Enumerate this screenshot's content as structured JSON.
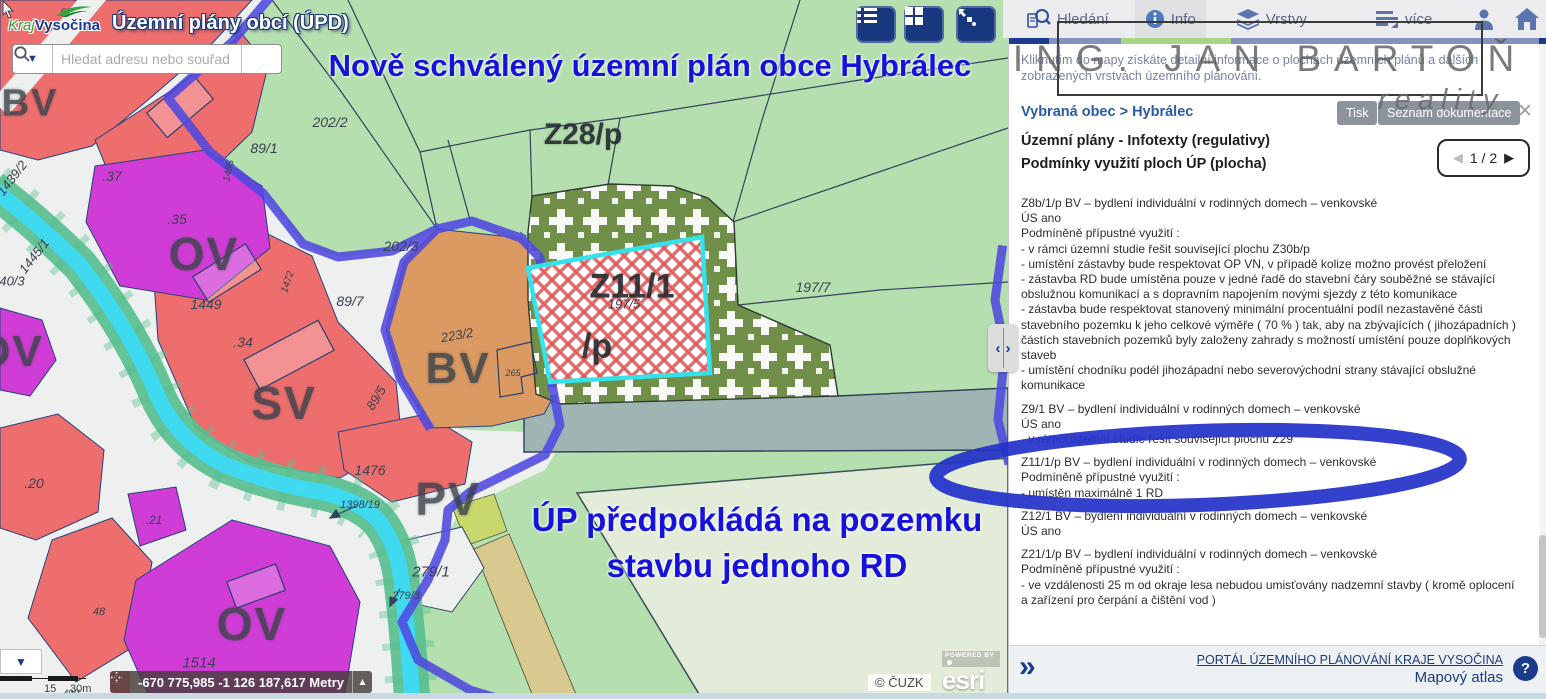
{
  "header": {
    "logo_prefix": "Kraj",
    "logo_name": "Vysočina",
    "app_title": "Územní plány obcí (ÚPD)"
  },
  "search": {
    "placeholder": "Hledat adresu nebo souřad"
  },
  "annotations": {
    "note_top": "Nově schválený územní plán obce Hybrálec",
    "note_bottom_line1": "ÚP předpokládá na pozemku",
    "note_bottom_line2": "stavbu jednoho RD"
  },
  "watermark": {
    "line1": "ING. JAN BARTOŇ",
    "line2": "reality"
  },
  "panel": {
    "tabs": [
      {
        "label": "Hledání",
        "icon": "search-doc-icon",
        "active": false
      },
      {
        "label": "Info",
        "icon": "info-icon",
        "active": true
      },
      {
        "label": "Vrstvy",
        "icon": "layers-icon",
        "active": false
      },
      {
        "label": "více",
        "icon": "more-lines-icon",
        "active": false
      }
    ],
    "intro": "Kliknutím do mapy získáte detailní informace o plochách územních plánů a dalších zobrazených vrstvách územního plánování.",
    "breadcrumb": "Vybraná obec > Hybrálec",
    "print_button": "Tisk",
    "docs_button": "Seznam dokumentace",
    "close_icon": "✕",
    "heading1": "Územní plány - Infotexty (regulativy)",
    "heading2": "Podmínky využití ploch ÚP (plocha)",
    "pagination": {
      "prev": "◀",
      "current": "1 / 2",
      "next": "▶"
    },
    "regulations": [
      {
        "lines": [
          "Z8b/1/p BV – bydlení individuální v rodinných domech – venkovské",
          "ÚS ano",
          "Podmíněně přípustné využití :",
          "- v rámci územní studie řešit související plochu Z30b/p",
          "- umístění zástavby bude respektovat OP VN, v případě kolize možno provést přeložení",
          "- zástavba RD bude umístěna pouze v jedné řadě do stavební čáry souběžné se stávající",
          "obslužnou komunikací a s dopravním napojením novými sjezdy z této komunikace",
          "- zástavba bude respektovat stanovený minimální procentuální podíl nezastavěné části",
          "stavebního pozemku k jeho celkové výměře ( 70 % ) tak, aby na zbývajících ( jihozápadních )",
          "částích stavebních pozemků byly založeny zahrady s možností umístění pouze doplňkových",
          "staveb",
          "- umístění chodníku podél jihozápadní nebo severovýchodní strany stávající obslužné",
          "komunikace"
        ]
      },
      {
        "lines": [
          "Z9/1 BV – bydlení individuální v rodinných domech – venkovské",
          "ÚS ano",
          "- v rámci územní studie řešit související plochu Z29"
        ]
      },
      {
        "lines": [
          "Z11/1/p BV – bydlení individuální v rodinných domech – venkovské",
          "Podmíněně přípustné využití :",
          "- umístěn maximálně 1 RD"
        ]
      },
      {
        "lines": [
          "Z12/1 BV – bydlení individuální v rodinných domech – venkovské",
          "ÚS ano"
        ]
      },
      {
        "lines": [
          "Z21/1/p BV – bydlení individuální v rodinných domech – venkovské",
          "Podmíněně přípustné využití :",
          "- ve vzdálenosti 25 m od okraje lesa nebudou umisťovány nadzemní stavby ( kromě oplocení",
          "a zařízení pro čerpání a čištění vod )"
        ]
      }
    ],
    "footer": {
      "expand": "»",
      "portal_link": "PORTÁL ÚZEMNÍHO PLÁNOVÁNÍ KRAJE VYSOČINA",
      "atlas": "Mapový atlas",
      "help": "?"
    }
  },
  "statusbar": {
    "coordinates": "-670 775,985 -1 126 187,617 Metry",
    "scale_mid": "15",
    "scale_end": "30m"
  },
  "attribution": {
    "cuzk": "© ČUZK",
    "powered_by": "POWERED BY",
    "esri": "esri"
  },
  "map": {
    "labels": [
      {
        "t": "BV",
        "x": 30,
        "y": 104,
        "s": 38,
        "k": "zone"
      },
      {
        "t": "OV",
        "x": 204,
        "y": 254,
        "s": 46,
        "k": "zone"
      },
      {
        "t": "OV",
        "x": 10,
        "y": 352,
        "s": 44,
        "k": "zone"
      },
      {
        "t": "SV",
        "x": 284,
        "y": 403,
        "s": 46,
        "k": "zone"
      },
      {
        "t": "BV",
        "x": 458,
        "y": 369,
        "s": 44,
        "k": "zone"
      },
      {
        "t": "PV",
        "x": 448,
        "y": 499,
        "s": 46,
        "k": "zone"
      },
      {
        "t": "OV",
        "x": 252,
        "y": 624,
        "s": 46,
        "k": "zone"
      },
      {
        "t": "Z28/p",
        "x": 583,
        "y": 135,
        "s": 30,
        "k": "plan"
      },
      {
        "t": "Z11/1",
        "x": 632,
        "y": 287,
        "s": 34,
        "k": "plan"
      },
      {
        "t": "/p",
        "x": 597,
        "y": 347,
        "s": 34,
        "k": "plan"
      },
      {
        "t": "57",
        "x": 66,
        "y": 13,
        "s": 10,
        "k": "parcel"
      },
      {
        "t": "202/2",
        "x": 330,
        "y": 122,
        "s": 14,
        "k": "parcel"
      },
      {
        "t": "89/1",
        "x": 264,
        "y": 148,
        "s": 14,
        "k": "parcel"
      },
      {
        "t": ".37",
        "x": 112,
        "y": 176,
        "s": 14,
        "k": "parcel"
      },
      {
        "t": "1439/2",
        "x": 12,
        "y": 178,
        "s": 13,
        "k": "parcel",
        "r": -52
      },
      {
        "t": ".35",
        "x": 177,
        "y": 219,
        "s": 14,
        "k": "parcel"
      },
      {
        "t": "1445/1",
        "x": 34,
        "y": 256,
        "s": 13,
        "k": "parcel",
        "r": -52
      },
      {
        "t": "40/3",
        "x": 12,
        "y": 281,
        "s": 13,
        "k": "parcel"
      },
      {
        "t": "1449",
        "x": 206,
        "y": 304,
        "s": 14,
        "k": "parcel"
      },
      {
        "t": ".34",
        "x": 243,
        "y": 342,
        "s": 14,
        "k": "parcel"
      },
      {
        "t": "202/3",
        "x": 401,
        "y": 246,
        "s": 14,
        "k": "parcel"
      },
      {
        "t": "89/7",
        "x": 350,
        "y": 301,
        "s": 14,
        "k": "parcel"
      },
      {
        "t": "223/2",
        "x": 457,
        "y": 335,
        "s": 13,
        "k": "parcel",
        "r": -10
      },
      {
        "t": "197/5",
        "x": 624,
        "y": 304,
        "s": 13,
        "k": "parcel"
      },
      {
        "t": "197/7",
        "x": 813,
        "y": 287,
        "s": 14,
        "k": "parcel"
      },
      {
        "t": "89/5",
        "x": 376,
        "y": 398,
        "s": 13,
        "k": "parcel",
        "r": -58
      },
      {
        "t": "1485",
        "x": 229,
        "y": 171,
        "s": 10,
        "k": "parcel",
        "r": -78
      },
      {
        "t": "1472",
        "x": 288,
        "y": 282,
        "s": 10,
        "k": "parcel",
        "r": -72
      },
      {
        "t": "265",
        "x": 513,
        "y": 373,
        "s": 9,
        "k": "parcel"
      },
      {
        "t": "1476",
        "x": 370,
        "y": 470,
        "s": 14,
        "k": "parcel"
      },
      {
        "t": "1398/19",
        "x": 360,
        "y": 505,
        "s": 11,
        "k": "parcel"
      },
      {
        "t": ".21",
        "x": 154,
        "y": 520,
        "s": 12,
        "k": "parcel"
      },
      {
        "t": "279/1",
        "x": 431,
        "y": 572,
        "s": 15,
        "k": "parcel"
      },
      {
        "t": "279/3",
        "x": 406,
        "y": 596,
        "s": 11,
        "k": "parcel"
      },
      {
        "t": "48",
        "x": 99,
        "y": 612,
        "s": 11,
        "k": "parcel"
      },
      {
        "t": ".20",
        "x": 34,
        "y": 483,
        "s": 14,
        "k": "parcel"
      },
      {
        "t": "1514",
        "x": 199,
        "y": 663,
        "s": 15,
        "k": "parcel"
      },
      {
        "t": "49/1",
        "x": 72,
        "y": 693,
        "s": 9,
        "k": "parcel"
      }
    ]
  },
  "colors": {
    "annotation_blue": "#1712d9",
    "boundary_blue": "#4f49e0",
    "parcel_highlight_cyan": "#35e1ea",
    "zone_red": "#ee6e6e",
    "zone_magenta": "#d03dd6",
    "zone_orange": "#db9a62",
    "zone_olive": "#70904a",
    "water_cyan": "#3fd9f0",
    "bank_green": "#58bf8f",
    "navy": "#1b3c8c"
  }
}
